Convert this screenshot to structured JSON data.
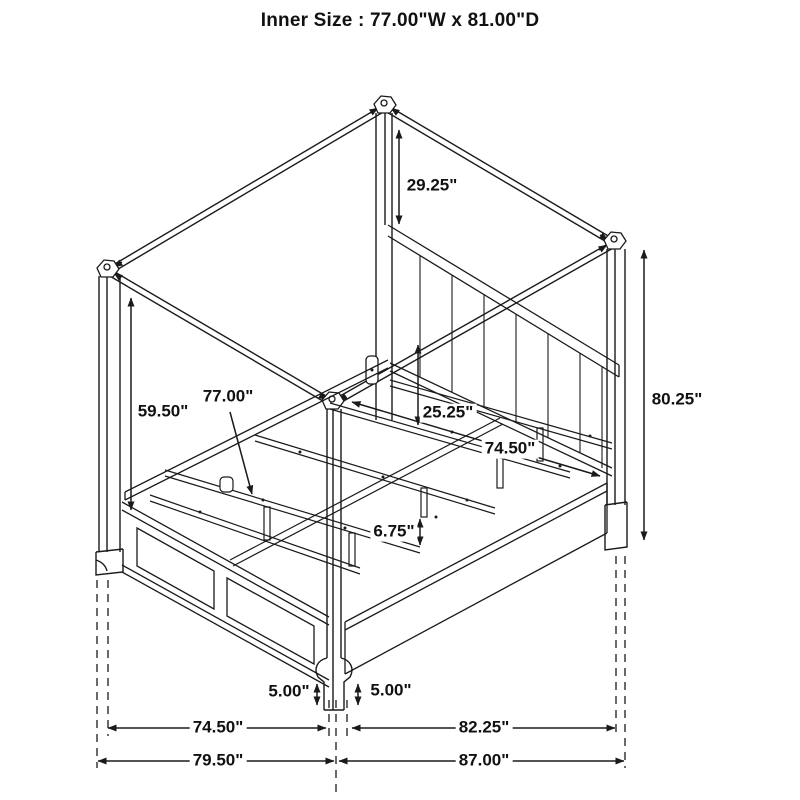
{
  "title": "Inner Size : 77.00\"W x 81.00\"D",
  "diagram_type": "canopy-bed-dimension-drawing",
  "colors": {
    "line": "#1a1a1a",
    "background": "#ffffff"
  },
  "dimensions": {
    "post_above_headboard": "29.25\"",
    "canopy_to_rail_left": "59.50\"",
    "inner_width_slats": "77.00\"",
    "headboard_panel_height": "25.25\"",
    "side_rail_length": "74.50\"",
    "overall_height": "80.25\"",
    "slat_leg_height": "6.75\"",
    "post_base_left": "5.00\"",
    "post_base_right": "5.00\"",
    "floor_width_inner": "74.50\"",
    "floor_depth_inner": "82.25\"",
    "floor_width_overall": "79.50\"",
    "floor_depth_overall": "87.00\""
  }
}
